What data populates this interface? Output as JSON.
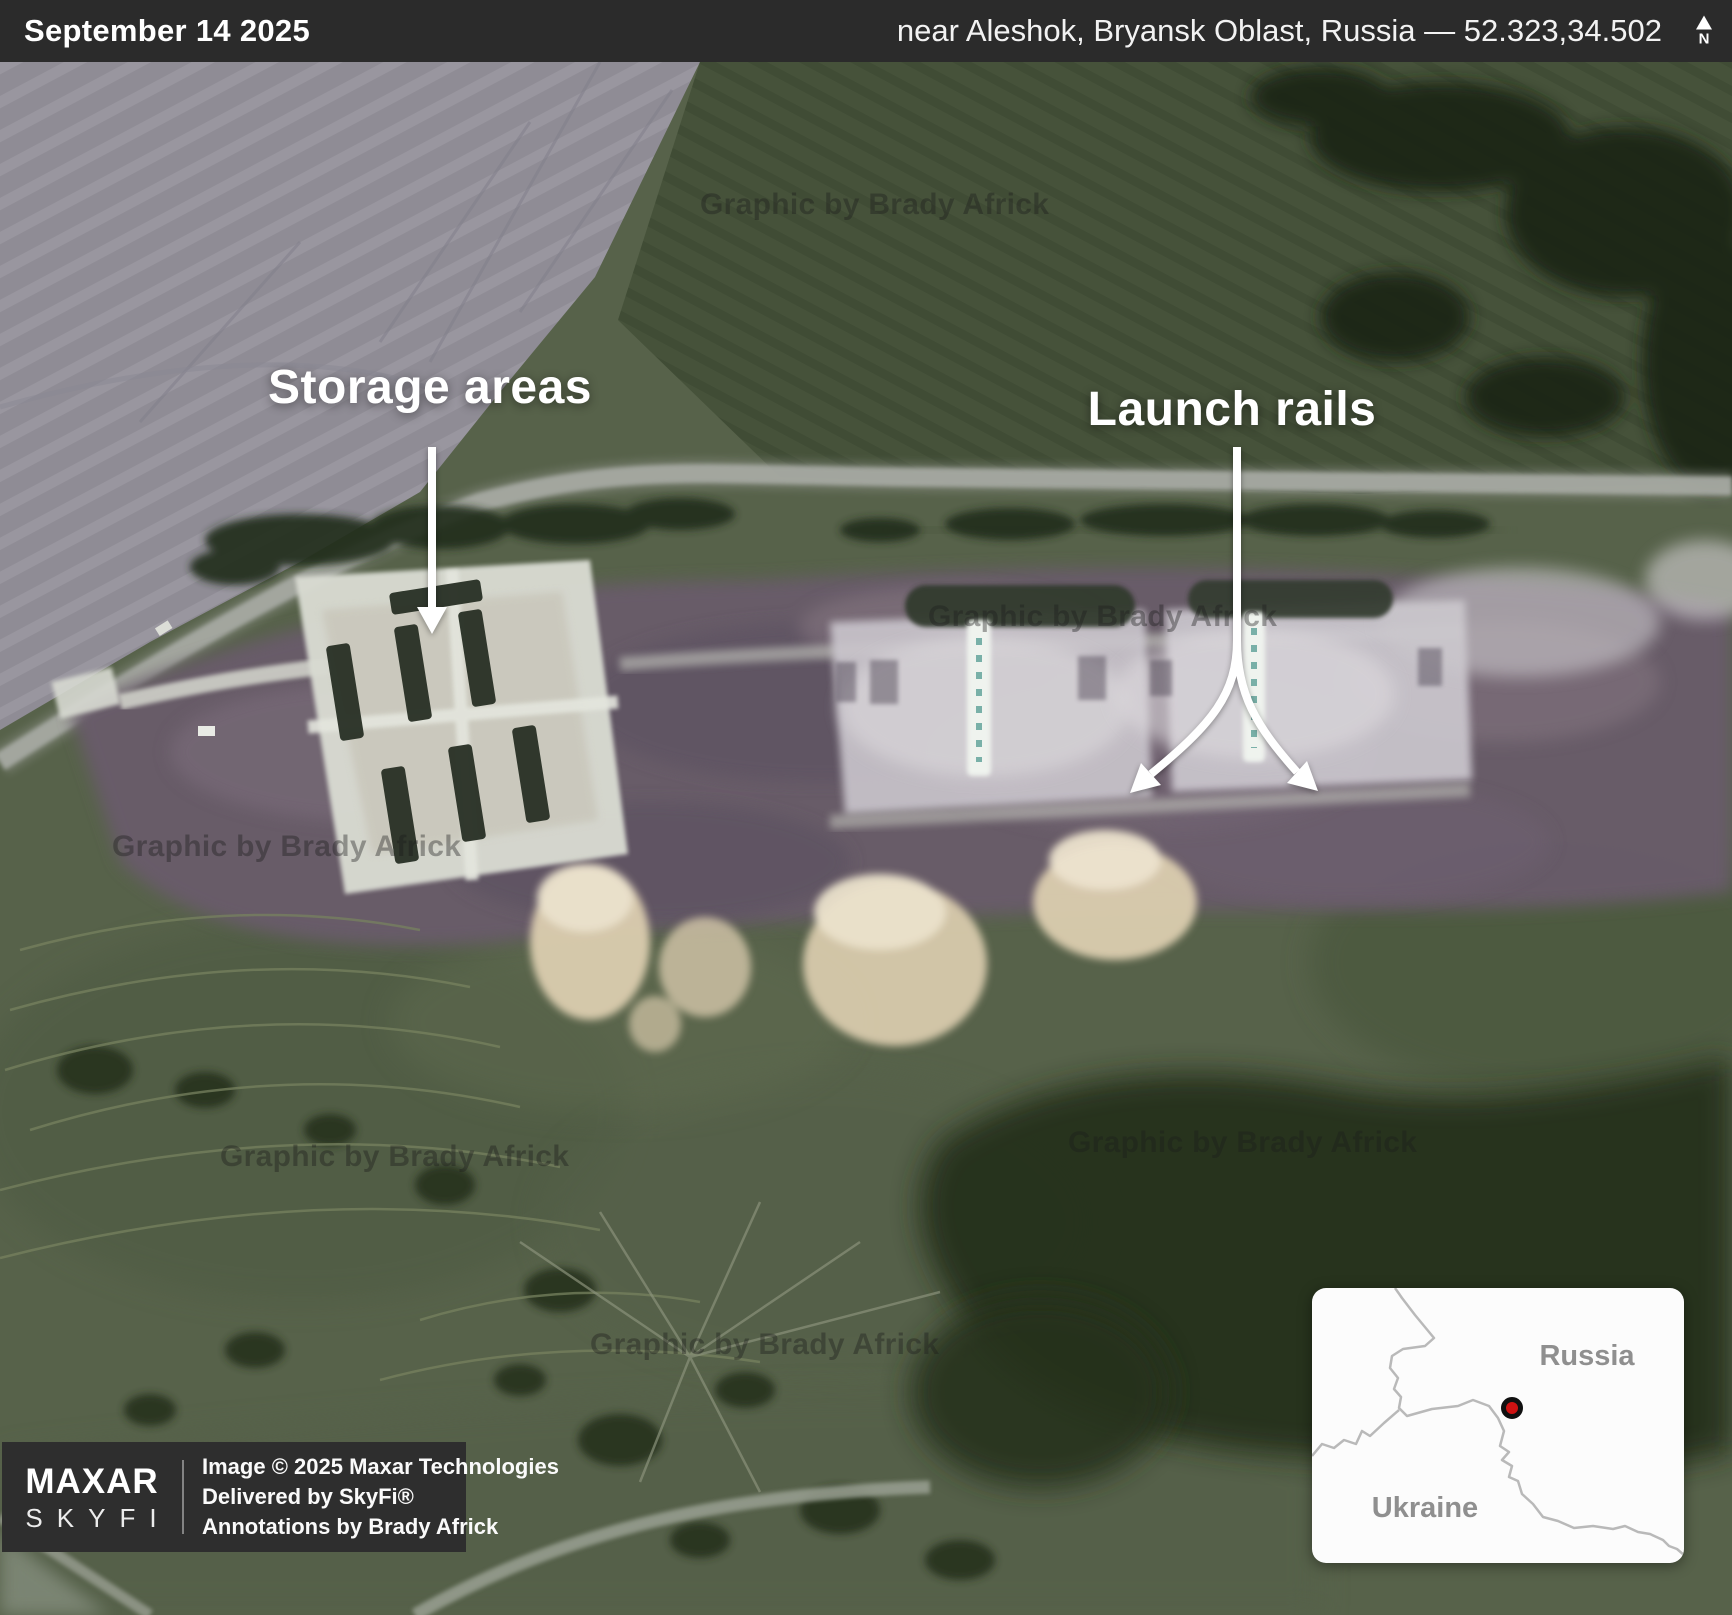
{
  "header": {
    "date": "September 14 2025",
    "location": "near Aleshok, Bryansk Oblast, Russia — 52.323,34.502",
    "north_label": "N"
  },
  "annotations": {
    "storage_label": "Storage areas",
    "launch_label": "Launch rails"
  },
  "watermark": {
    "text": "Graphic by Brady Africk"
  },
  "credits": {
    "maxar": "MAXAR",
    "skyfi": "SKYFI",
    "lines": [
      "Image © 2025 Maxar Technologies",
      "Delivered by SkyFi®",
      "Annotations by Brady Africk"
    ]
  },
  "inset_map": {
    "russia": "Russia",
    "ukraine": "Ukraine",
    "marker_color": "#ce1212"
  },
  "colors": {
    "topbar": "#2b2b2b",
    "annotation": "#ffffff",
    "border_line": "#b9b9b9"
  }
}
